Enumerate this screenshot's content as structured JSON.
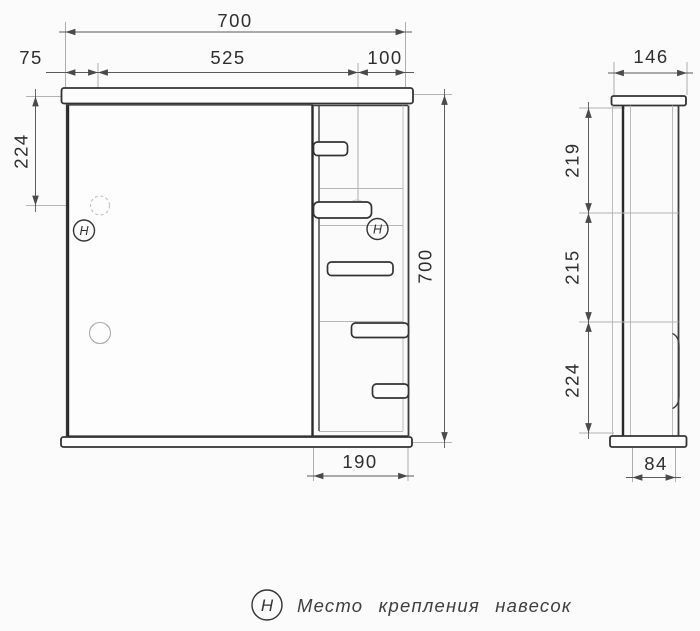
{
  "front_view": {
    "dim_total_width": "700",
    "dim_left_offset": "75",
    "dim_door_width": "525",
    "dim_shelf_width": "100",
    "dim_hinge_offset": "224",
    "dim_total_height": "700",
    "dim_shelf_bottom_width": "190",
    "hinge_symbol": "Н"
  },
  "side_view": {
    "dim_depth": "146",
    "dim_top_section": "219",
    "dim_middle_section": "215",
    "dim_bottom_section": "224",
    "dim_body_depth": "84"
  },
  "legend": {
    "symbol": "Н",
    "label": "Место крепления навесок"
  },
  "colors": {
    "background": "#fbfbfb",
    "line": "#3d3d3d",
    "light_line": "#b5b5b5",
    "dim_line": "#5a5a5a",
    "text": "#2e2e2e"
  }
}
